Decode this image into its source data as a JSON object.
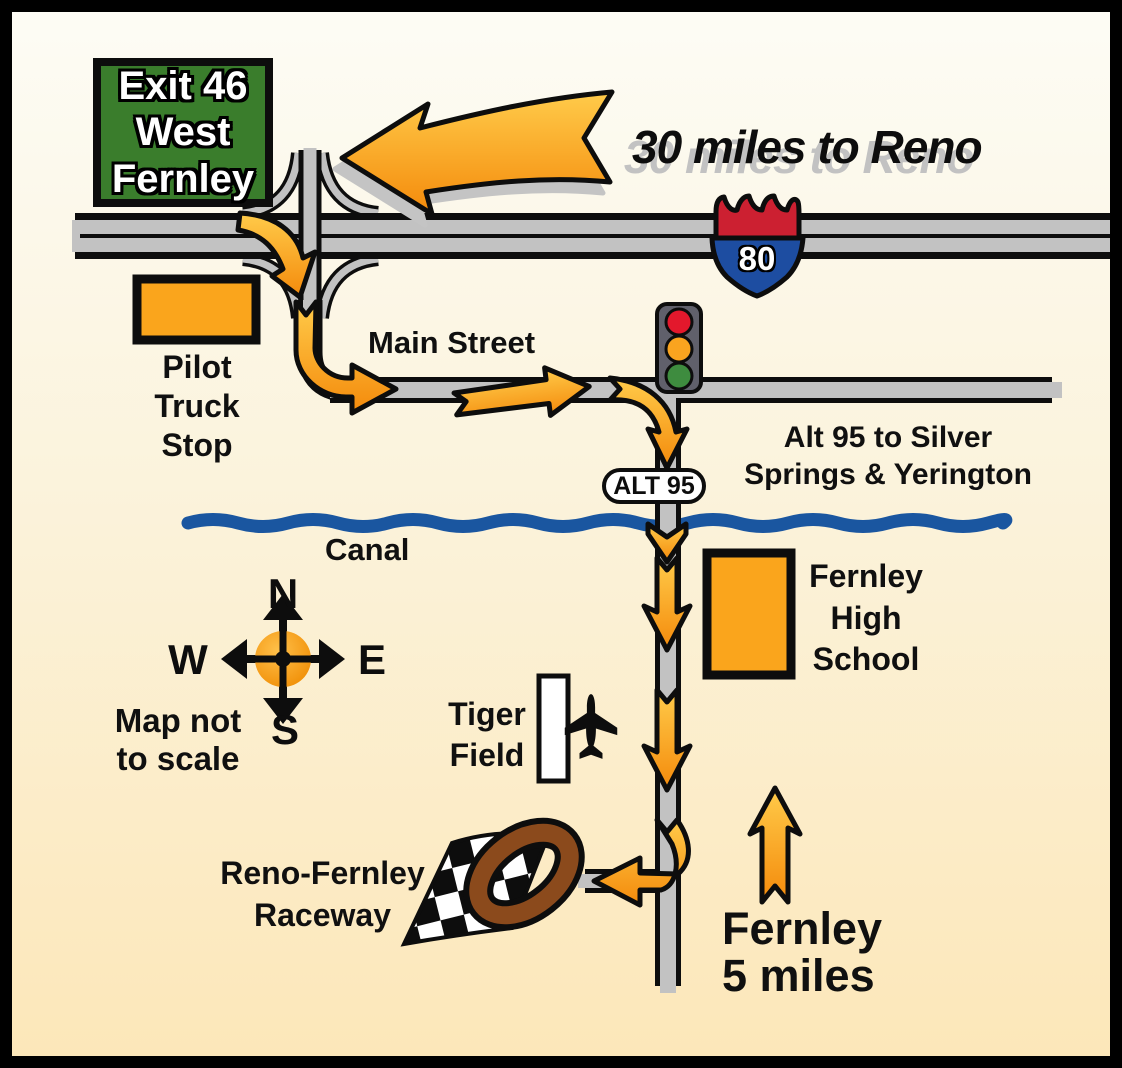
{
  "map": {
    "exit_sign": {
      "lines": "Exit 46\nWest\nFernley"
    },
    "reno_direction": {
      "label": "30 miles to Reno"
    },
    "interstate_shield": {
      "number": "80"
    },
    "pilot_truck_stop": {
      "label": "Pilot\nTruck\nStop"
    },
    "main_street": {
      "label": "Main Street"
    },
    "alt95_destination": {
      "label": "Alt 95 to Silver\nSprings & Yerington"
    },
    "alt95_badge": {
      "label": "ALT 95"
    },
    "canal": {
      "label": "Canal"
    },
    "compass": {
      "north": "N",
      "west": "W",
      "east": "E",
      "south": "S",
      "note": "Map not\nto scale"
    },
    "high_school": {
      "label": "Fernley\nHigh\nSchool"
    },
    "tiger_field": {
      "label": "Tiger\nField"
    },
    "raceway": {
      "label": "Reno-Fernley\nRaceway"
    },
    "fernley_distance": {
      "label": "Fernley\n5 miles"
    },
    "colors": {
      "route_arrow_orange": "#F9A01B",
      "building_orange": "#FAA51C",
      "road_gray": "#C2C2C2",
      "canal_blue": "#1A56A0",
      "sign_green": "#3A7D2C",
      "shield_red": "#CC2031",
      "shield_blue": "#1D4DA1",
      "track_brown": "#8B4A1C",
      "signal_red": "#E3182C",
      "signal_amber": "#FAA41F",
      "signal_green": "#3E8C3F",
      "border_black": "#000000"
    }
  }
}
